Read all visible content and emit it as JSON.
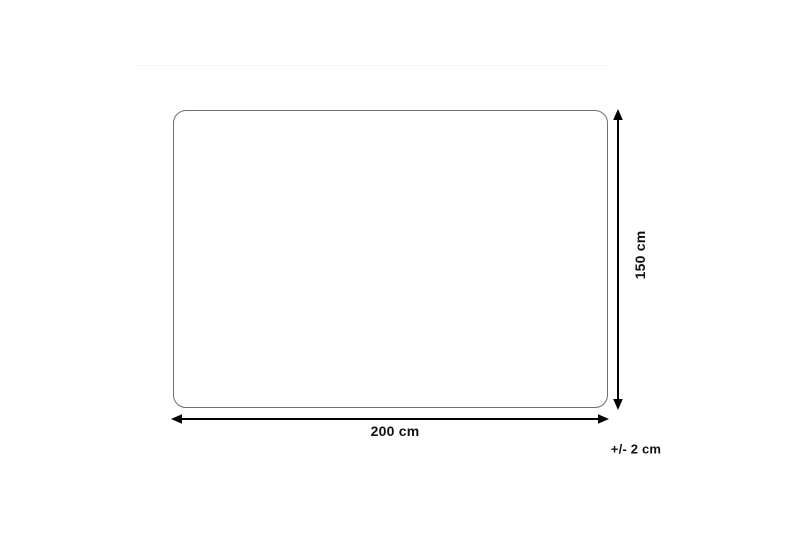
{
  "diagram": {
    "type": "product-dimension-diagram",
    "shape": "rounded-rectangle",
    "width_label": "200 cm",
    "height_label": "150 cm",
    "tolerance_label": "+/- 2 cm",
    "colors": {
      "background": "#ffffff",
      "outline": "#6f6f6f",
      "arrows_and_text": "#000000"
    }
  }
}
